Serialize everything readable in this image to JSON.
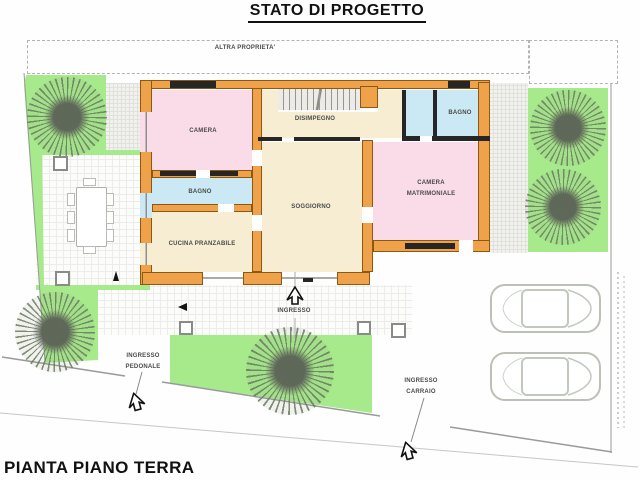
{
  "page": {
    "title": "STATO DI PROGETTO",
    "caption": "PIANTA PIANO TERRA"
  },
  "site": {
    "neighbor_label": "ALTRA PROPRIETA'",
    "main_entrance_label": "INGRESSO",
    "pedestrian_entrance_label": "INGRESSO PEDONALE",
    "vehicle_entrance_label": "INGRESSO CARRAIO"
  },
  "rooms": {
    "camera": {
      "label": "CAMERA",
      "fill": "#fadce9"
    },
    "disimpegno": {
      "label": "DISIMPEGNO",
      "fill": "#f6edd2"
    },
    "bagno_top": {
      "label": "BAGNO",
      "fill": "#cbe9f4"
    },
    "camera_matrimoniale": {
      "label": "CAMERA MATRIMONIALE",
      "fill": "#fadce9"
    },
    "soggiorno": {
      "label": "SOGGIORNO",
      "fill": "#f6edd2"
    },
    "bagno_left": {
      "label": "BAGNO",
      "fill": "#cbe9f4"
    },
    "cucina": {
      "label": "CUCINA PRANZABILE",
      "fill": "#f6edd2"
    }
  },
  "colors": {
    "wall": "#f0a24a",
    "wall_outline": "#8a5a14",
    "partition": "#262626",
    "garden_green": "#a6ea8c",
    "bedroom_pink": "#fadce9",
    "bathroom_blue": "#cbe9f4",
    "living_beige": "#f6edd2",
    "boundary_line": "#9a9a9a",
    "car_outline": "#bcc1b8",
    "tree_gray_green": "#6a765e"
  },
  "icons": {
    "tree": "tree-icon",
    "car": "car-icon",
    "entrance_arrow": "entrance-arrow-icon",
    "path_arrow_left": "arrow-left-icon",
    "path_arrow_up": "arrow-up-icon"
  }
}
